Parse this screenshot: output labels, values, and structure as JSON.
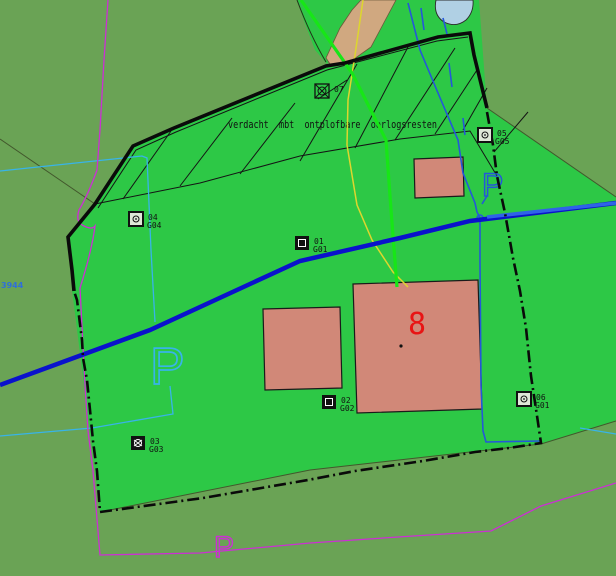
{
  "map": {
    "annotation": "verdacht  mbt  ontplofbare  oorlogsresten",
    "building_number": "8",
    "parcel_label": "3944",
    "parking_label_west": "P",
    "parking_label_south": "P",
    "parking_label_east": "P",
    "markers": [
      {
        "id": "01",
        "code": "G01"
      },
      {
        "id": "02",
        "code": "G02"
      },
      {
        "id": "03",
        "code": "G03"
      },
      {
        "id": "04",
        "code": "G04"
      },
      {
        "id": "05",
        "code": "G05"
      },
      {
        "id": "06",
        "code": "G01"
      },
      {
        "id": "07",
        "code": ""
      }
    ],
    "colors": {
      "background_olive": "#6aa355",
      "parcel_green": "#2dc846",
      "building_salmon": "#d18878",
      "road_tan": "#d0a880",
      "pond_blue": "#b0d0e4",
      "waterline_blue": "#0a12cc",
      "waterline_light_blue": "#2f63e8",
      "stream_blue": "#2458d8",
      "utility_cyan": "#38b4e8",
      "boundary_magenta": "#cc2fd4",
      "cable_yellow": "#ddd62e",
      "trace_lime": "#17e617",
      "label_red": "#e81414",
      "line_black": "#111111"
    }
  }
}
